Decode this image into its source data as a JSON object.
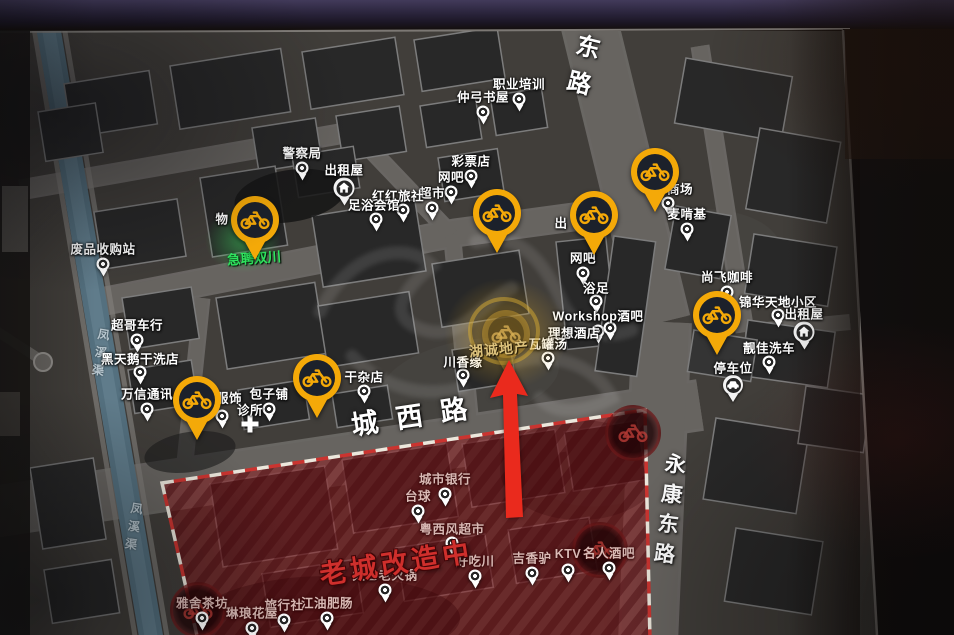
{
  "streets": [
    {
      "label": "东路"
    },
    {
      "label": "城西路"
    },
    {
      "label": "永康东路"
    }
  ],
  "waterway": {
    "label": "凤溪渠"
  },
  "renovation": {
    "banner": "老城改造中"
  },
  "hiring": {
    "label": "急聘双川"
  },
  "highlight": {
    "label": "湖诚地产"
  },
  "partials": [
    {
      "label": "物"
    },
    {
      "label": "出"
    }
  ],
  "pois": [
    {
      "label": "职业培训",
      "icon": "dot",
      "x": 519,
      "y": 99
    },
    {
      "label": "仲弓书屋",
      "icon": "dot",
      "x": 483,
      "y": 112
    },
    {
      "label": "警察局",
      "icon": "dot",
      "x": 302,
      "y": 168
    },
    {
      "label": "出租屋",
      "icon": "house",
      "x": 344,
      "y": 188,
      "ldy": -19
    },
    {
      "label": "彩票店",
      "icon": "dot",
      "x": 471,
      "y": 176
    },
    {
      "label": "网吧",
      "icon": "dot",
      "x": 451,
      "y": 192
    },
    {
      "label": "超市",
      "icon": "dot",
      "x": 432,
      "y": 208
    },
    {
      "label": "红红旅社",
      "icon": "dot",
      "x": 403,
      "y": 210,
      "ldx": -5,
      "ldy": -15
    },
    {
      "label": "足浴会馆",
      "icon": "dot",
      "x": 376,
      "y": 219,
      "ldx": -2,
      "ldy": -15
    },
    {
      "label": "废品收购站",
      "icon": "dot",
      "x": 103,
      "y": 264
    },
    {
      "label": "超哥车行",
      "icon": "dot",
      "x": 137,
      "y": 340
    },
    {
      "label": "黑天鹅干洗店",
      "icon": "dot",
      "x": 140,
      "y": 372,
      "ldy": -14
    },
    {
      "label": "万信通讯",
      "icon": "dot",
      "x": 147,
      "y": 409
    },
    {
      "label": "服饰",
      "icon": "dot",
      "x": 222,
      "y": 416,
      "ldx": 7,
      "ldy": -19
    },
    {
      "label": "诊所",
      "icon": "cross",
      "x": 250,
      "y": 424,
      "ldy": -15
    },
    {
      "label": "包子铺",
      "icon": "dot",
      "x": 269,
      "y": 409
    },
    {
      "label": "干杂店",
      "icon": "dot",
      "x": 364,
      "y": 391,
      "ldy": -15
    },
    {
      "label": "川香缘",
      "icon": "dot",
      "x": 463,
      "y": 375,
      "ldy": -14
    },
    {
      "label": "网吧",
      "icon": "dot",
      "x": 583,
      "y": 273
    },
    {
      "label": "浴足",
      "icon": "dot",
      "x": 596,
      "y": 301,
      "ldy": -14
    },
    {
      "label": "Workshop酒吧",
      "icon": "dot",
      "x": 598,
      "y": 331
    },
    {
      "label": "理想酒店",
      "icon": "dot",
      "x": 610,
      "y": 328,
      "ldx": -36,
      "ldy": 4
    },
    {
      "label": "瓦罐汤",
      "icon": "dot",
      "x": 548,
      "y": 358,
      "ldy": -15
    },
    {
      "label": "商场",
      "icon": "dot",
      "x": 668,
      "y": 203,
      "ldx": 12,
      "ldy": -15
    },
    {
      "label": "麦啃基",
      "icon": "dot",
      "x": 687,
      "y": 229
    },
    {
      "label": "尚飞咖啡",
      "icon": "dot",
      "x": 727,
      "y": 292
    },
    {
      "label": "锦华天地小区",
      "icon": "dot",
      "x": 778,
      "y": 315,
      "ldy": -14
    },
    {
      "label": "出租屋",
      "icon": "house",
      "x": 804,
      "y": 332,
      "ldy": -19
    },
    {
      "label": "靓佳洗车",
      "icon": "dot",
      "x": 769,
      "y": 362,
      "ldy": -15
    },
    {
      "label": "停车位",
      "icon": "car",
      "x": 733,
      "y": 385,
      "ldy": -18
    },
    {
      "label": "城市银行",
      "icon": "dot",
      "x": 445,
      "y": 494,
      "zone": "red"
    },
    {
      "label": "台球",
      "icon": "dot",
      "x": 418,
      "y": 511,
      "zone": "red"
    },
    {
      "label": "粤西风超市",
      "icon": "dot",
      "x": 452,
      "y": 543,
      "zone": "red",
      "ldy": -15
    },
    {
      "label": "好吃川",
      "icon": "dot",
      "x": 475,
      "y": 576,
      "zone": "red"
    },
    {
      "label": "吉香驴",
      "icon": "dot",
      "x": 532,
      "y": 573,
      "zone": "red"
    },
    {
      "label": "KTV",
      "icon": "dot",
      "x": 568,
      "y": 570,
      "zone": "red"
    },
    {
      "label": "名人酒吧",
      "icon": "dot",
      "x": 609,
      "y": 568,
      "zone": "red"
    },
    {
      "label": "太乙老火锅",
      "icon": "dot",
      "x": 385,
      "y": 590,
      "zone": "red"
    },
    {
      "label": "江油肥肠",
      "icon": "dot",
      "x": 327,
      "y": 618,
      "zone": "red"
    },
    {
      "label": "旅行社",
      "icon": "dot",
      "x": 284,
      "y": 620,
      "zone": "red"
    },
    {
      "label": "琳琅花屋",
      "icon": "dot",
      "x": 252,
      "y": 628,
      "zone": "red"
    },
    {
      "label": "雅舍茶坊",
      "icon": "dot",
      "x": 202,
      "y": 618,
      "zone": "red"
    }
  ],
  "bike_stations": [
    {
      "x": 255,
      "y": 220
    },
    {
      "x": 497,
      "y": 213
    },
    {
      "x": 594,
      "y": 215
    },
    {
      "x": 655,
      "y": 172
    },
    {
      "x": 717,
      "y": 315
    },
    {
      "x": 197,
      "y": 400
    },
    {
      "x": 317,
      "y": 378
    }
  ],
  "disabled_bike_stations": [
    {
      "x": 633,
      "y": 433
    },
    {
      "x": 600,
      "y": 550
    },
    {
      "x": 198,
      "y": 610
    }
  ],
  "colors": {
    "bike_pin": "#f4a908",
    "alert_red": "#ea2a1d",
    "zone_red": "#8c161a",
    "hiring_green": "#2fe35e",
    "highlight_gold": "#d8ab38"
  }
}
